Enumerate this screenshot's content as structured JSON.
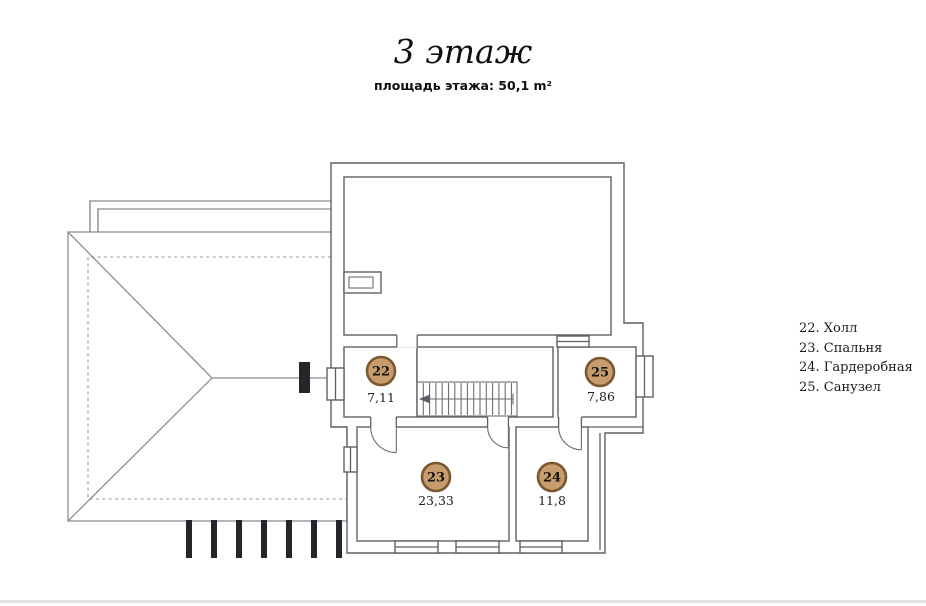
{
  "page": {
    "title": "3 этаж",
    "subtitle": "площадь этажа: 50,1 m²"
  },
  "plan": {
    "rooms": [
      {
        "number": "22",
        "name": "Холл",
        "area": "7,11"
      },
      {
        "number": "23",
        "name": "Спальня",
        "area": "23,33"
      },
      {
        "number": "24",
        "name": "Гардеробная",
        "area": "11,8"
      },
      {
        "number": "25",
        "name": "Санузел",
        "area": "7,86"
      }
    ]
  },
  "legend": {
    "items": [
      "22. Холл",
      "23. Спальня",
      "24. Гардеробная",
      "25. Санузел"
    ]
  },
  "colors": {
    "badge_fill": "#c79d6d",
    "badge_border": "#7b572f",
    "wall_line": "#5c6066",
    "roof_line": "#8d8f92",
    "bottom_divider": "#dee3dc"
  }
}
